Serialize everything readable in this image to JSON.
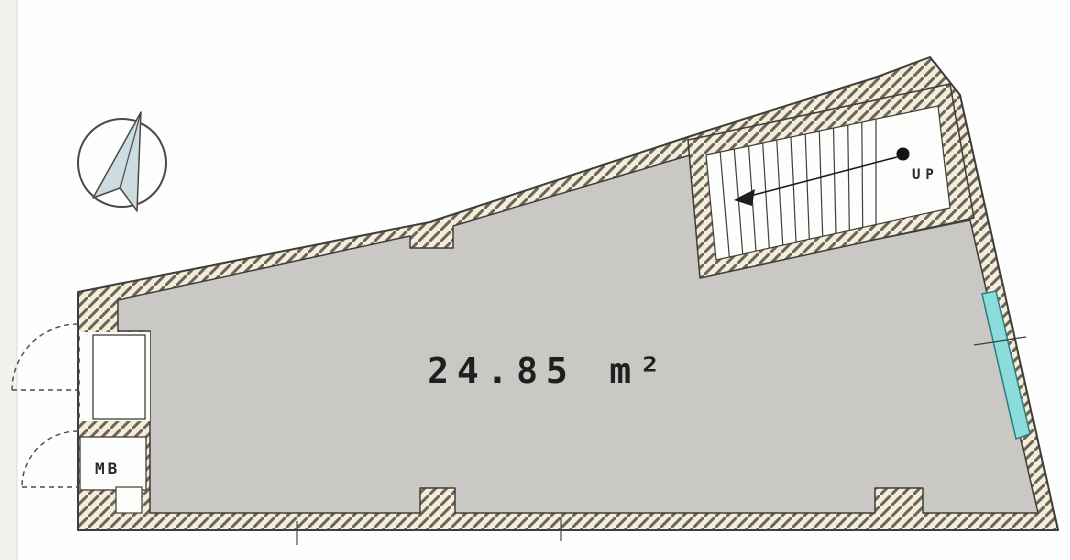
{
  "floor_plan": {
    "type": "architectural-floor-plan",
    "area_label": {
      "value": "24.85",
      "unit": "m²"
    },
    "room": {
      "floor_color": "#c9c8c5"
    },
    "stairs": {
      "label": "UP",
      "tread_count": 11,
      "arrow_direction": "left"
    },
    "mailbox": {
      "label": "MB"
    },
    "compass": {
      "name": "north-arrow",
      "fill": "#ccdce0"
    },
    "window": {
      "fill": "#8ddcdc",
      "outline": "#2d7d7d"
    },
    "walls": {
      "fill": "#f4edda",
      "hatch": "#6a665a",
      "outline": "#3f3e3a"
    },
    "background": "#fefefe"
  }
}
